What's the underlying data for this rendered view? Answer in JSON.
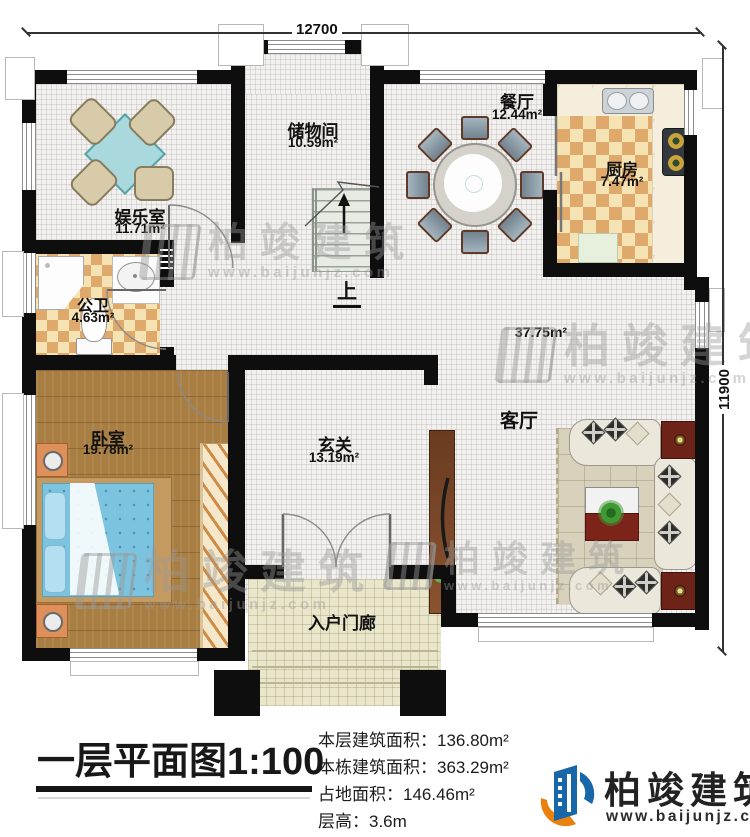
{
  "dimensions": {
    "top": "12700",
    "right": "11900"
  },
  "rooms": {
    "entertainment": {
      "name": "娱乐室",
      "area": "11.71m²"
    },
    "storage": {
      "name": "储物间",
      "area": "10.59m²"
    },
    "dining": {
      "name": "餐厅",
      "area": "12.44m²"
    },
    "kitchen": {
      "name": "厨房",
      "area": "7.47m²"
    },
    "bathroom": {
      "name": "公卫",
      "area": "4.63m²"
    },
    "bedroom": {
      "name": "卧室",
      "area": "19.78m²"
    },
    "entry": {
      "name": "玄关",
      "area": "13.19m²"
    },
    "living": {
      "name": "客厅",
      "area": "37.75m²"
    },
    "porch": {
      "name": "入户门廊"
    }
  },
  "stairs": {
    "up_label": "上"
  },
  "title": {
    "text": "一层平面图",
    "scale": "1:100"
  },
  "stats": [
    {
      "label": "本层建筑面积：",
      "value": "136.80m²"
    },
    {
      "label": "本栋建筑面积：",
      "value": "363.29m²"
    },
    {
      "label": "占地面积：",
      "value": "146.46m²"
    },
    {
      "label": "层高：",
      "value": "3.6m"
    }
  ],
  "brand": {
    "name": "柏竣建筑",
    "url": "www.baijunjz.com"
  },
  "watermark": {
    "name": "柏竣建筑",
    "url": "www.baijunjz.com"
  },
  "colors": {
    "accent_blue": "#1767a9",
    "accent_orange": "#e8820c",
    "wall": "#0e0e0e"
  }
}
